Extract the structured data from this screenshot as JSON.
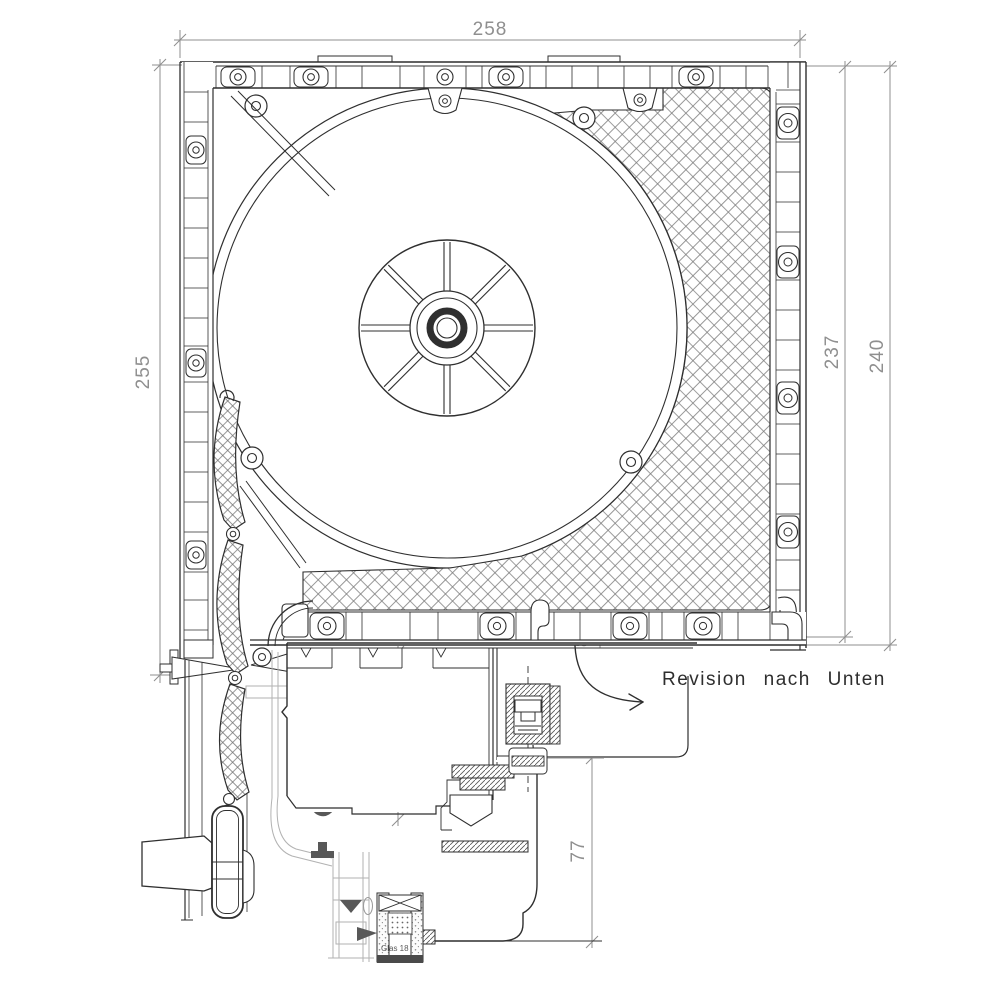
{
  "drawing": {
    "dimensions": {
      "box_width": "258",
      "box_height_left": "255",
      "height_inner_right": "237",
      "height_outer_right": "240",
      "revision_offset": "17,8",
      "frame_depth": "70",
      "sash_depth": "77"
    },
    "annotations": {
      "revision_note": "Revision nach Unten",
      "glazing_label": "Glas 18"
    },
    "colors": {
      "line": "#2f2f2f",
      "dimension": "#8f8f8f",
      "light_detail": "#b2b2b2",
      "background": "#ffffff"
    }
  }
}
